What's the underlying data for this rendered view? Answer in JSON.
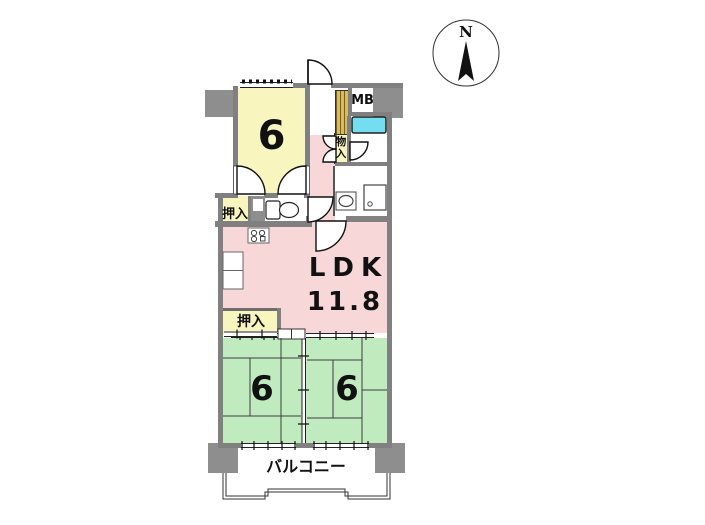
{
  "compass": {
    "north_label": "N"
  },
  "plan": {
    "bedroom_top": {
      "size_label": "6"
    },
    "bedroom_left": {
      "size_label": "6"
    },
    "bedroom_right": {
      "size_label": "6"
    },
    "ldk": {
      "name_label": "LDK",
      "size_label": "11.8"
    },
    "balcony_label": "バルコニー",
    "closet_top_label": "押入",
    "closet_mid_label": "押入",
    "storage_label": "物入",
    "meter_box_label": "MB"
  },
  "colors": {
    "bedroom_fill": "#f8f5be",
    "ldk_fill": "#f7d7d7",
    "tatami_fill": "#bfebbf",
    "bathtub_fill": "#72deef",
    "wall": "#808080",
    "pillar": "#8e8e8e",
    "shoe_cabinet": "#d8b964"
  }
}
